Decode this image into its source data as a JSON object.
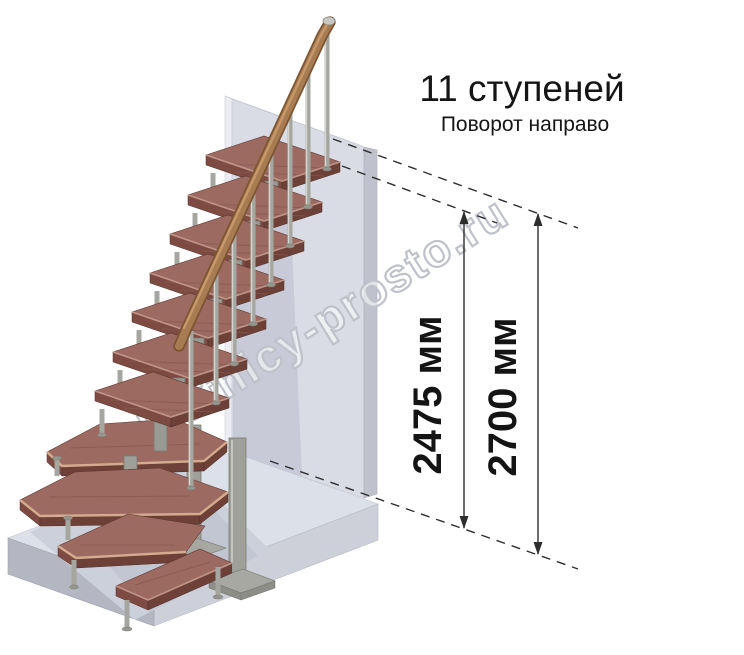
{
  "header": {
    "title": "11 ступеней",
    "subtitle": "Поворот направо"
  },
  "dimensions": {
    "inner": "2475 мм",
    "outer": "2700 мм"
  },
  "watermark": {
    "text": "lestnicy-prosto.ru"
  },
  "colors": {
    "tread_top": "#9c6a60",
    "tread_front": "#6e4138",
    "tread_side": "#7e4b42",
    "handrail": "#a87c52",
    "metal": "#a6a6a0",
    "wall": "#d9dce5",
    "wall_side": "#bfc2cc",
    "floor": "#dce0e9",
    "floor_front": "#cdd0d9",
    "dimension_line": "#2e2e2e",
    "text": "#151515",
    "watermark_outline": "#bfc2ca"
  }
}
